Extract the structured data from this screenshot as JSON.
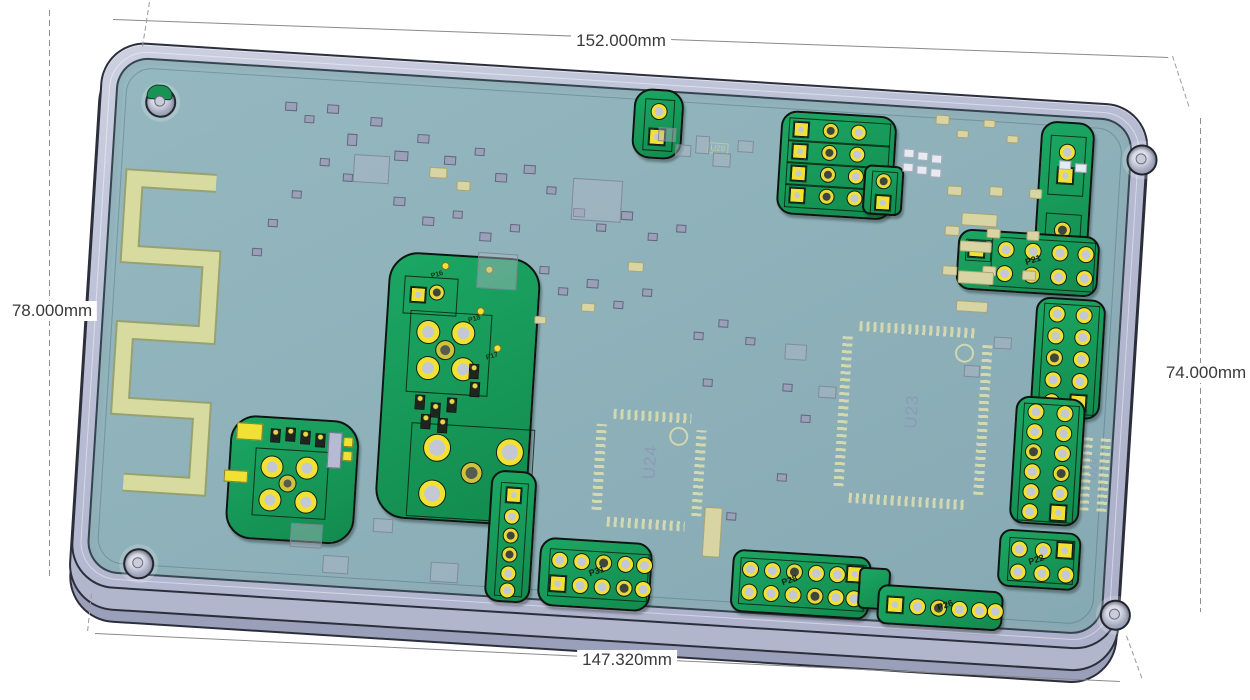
{
  "dimensions": {
    "top_width": "152.000mm",
    "left_height": "78.000mm",
    "right_height": "74.000mm",
    "bottom_width": "147.320mm"
  },
  "silkscreen": {
    "u23": "U23",
    "u24": "U24",
    "u20": "U20",
    "u28": "U28",
    "fb2": "FB2"
  },
  "connectors": {
    "p16": "P16",
    "p17": "P17",
    "p18": "P18",
    "p21": "P21",
    "p22": "P22",
    "p26": "P26",
    "p28": "P28",
    "p31": "P31"
  },
  "colors": {
    "enclosure": "#b8bcd4",
    "pcb_surface": "#8fb2ba",
    "copper_island_green": "#17a35e",
    "pad_yellow": "#f2e135",
    "antenna_trace": "#d6d99f",
    "dimension_text": "#3a3a3a"
  }
}
